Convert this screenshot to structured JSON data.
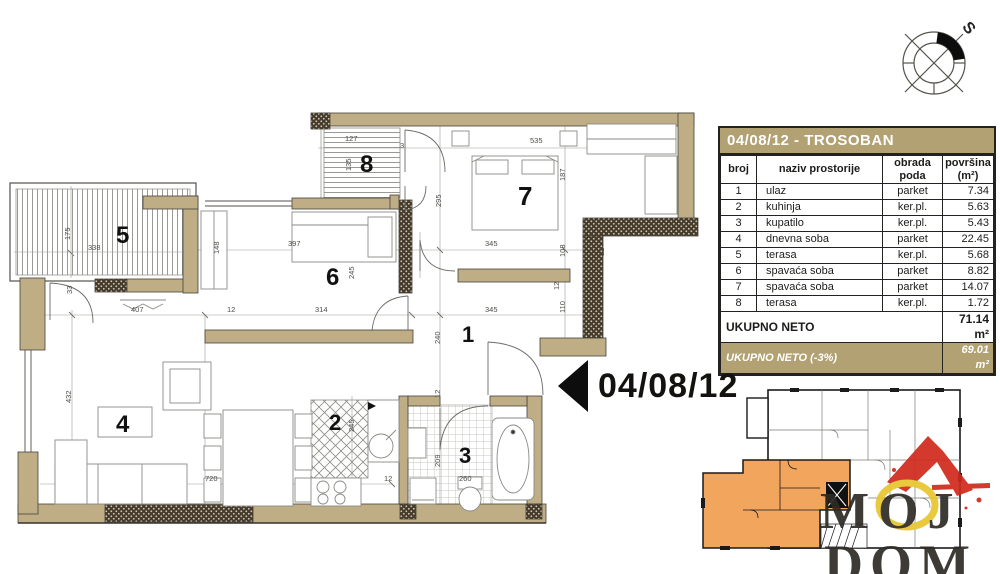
{
  "colors": {
    "wall_tan": "#bfae85",
    "table_header_tan": "#b2a173",
    "unit_orange": "#f2a55c",
    "logo_red": "#d02a1c",
    "logo_yellow": "#e8c52e"
  },
  "compass": {
    "north_label": "S"
  },
  "spec_table": {
    "title": "04/08/12 - TROSOBAN",
    "columns": [
      "broj",
      "naziv prostorije",
      "obrada poda",
      "površina (m²)"
    ],
    "rows": [
      {
        "broj": "1",
        "naziv": "ulaz",
        "obrada": "parket",
        "povrsina": "7.34"
      },
      {
        "broj": "2",
        "naziv": "kuhinja",
        "obrada": "ker.pl.",
        "povrsina": "5.63"
      },
      {
        "broj": "3",
        "naziv": "kupatilo",
        "obrada": "ker.pl.",
        "povrsina": "5.43"
      },
      {
        "broj": "4",
        "naziv": "dnevna soba",
        "obrada": "parket",
        "povrsina": "22.45"
      },
      {
        "broj": "5",
        "naziv": "terasa",
        "obrada": "ker.pl.",
        "povrsina": "5.68"
      },
      {
        "broj": "6",
        "naziv": "spavaća soba",
        "obrada": "parket",
        "povrsina": "8.82"
      },
      {
        "broj": "7",
        "naziv": "spavaća soba",
        "obrada": "parket",
        "povrsina": "14.07"
      },
      {
        "broj": "8",
        "naziv": "terasa",
        "obrada": "ker.pl.",
        "povrsina": "1.72"
      }
    ],
    "total_label": "UKUPNO NETO",
    "total_value": "71.14 m²",
    "net_label": "UKUPNO NETO (-3%)",
    "net_value": "69.01 m²"
  },
  "marker": {
    "label": "04/08/12"
  },
  "logo": {
    "line1": "MOJ",
    "line2": "DOM"
  },
  "plan": {
    "room_labels": [
      "1",
      "2",
      "3",
      "4",
      "5",
      "6",
      "7",
      "8"
    ],
    "dims": [
      {
        "t": "175"
      },
      {
        "t": "338"
      },
      {
        "t": "33"
      },
      {
        "t": "407"
      },
      {
        "t": "12"
      },
      {
        "t": "314"
      },
      {
        "t": "345"
      },
      {
        "t": "432"
      },
      {
        "t": "720"
      },
      {
        "t": "127"
      },
      {
        "t": "135"
      },
      {
        "t": "3"
      },
      {
        "t": "295"
      },
      {
        "t": "535"
      },
      {
        "t": "187"
      },
      {
        "t": "345"
      },
      {
        "t": "108"
      },
      {
        "t": "397"
      },
      {
        "t": "245"
      },
      {
        "t": "148"
      },
      {
        "t": "240"
      },
      {
        "t": "110"
      },
      {
        "t": "12"
      },
      {
        "t": "12"
      },
      {
        "t": "209"
      },
      {
        "t": "260"
      },
      {
        "t": "12"
      },
      {
        "t": "245"
      },
      {
        "t": "12"
      }
    ]
  }
}
